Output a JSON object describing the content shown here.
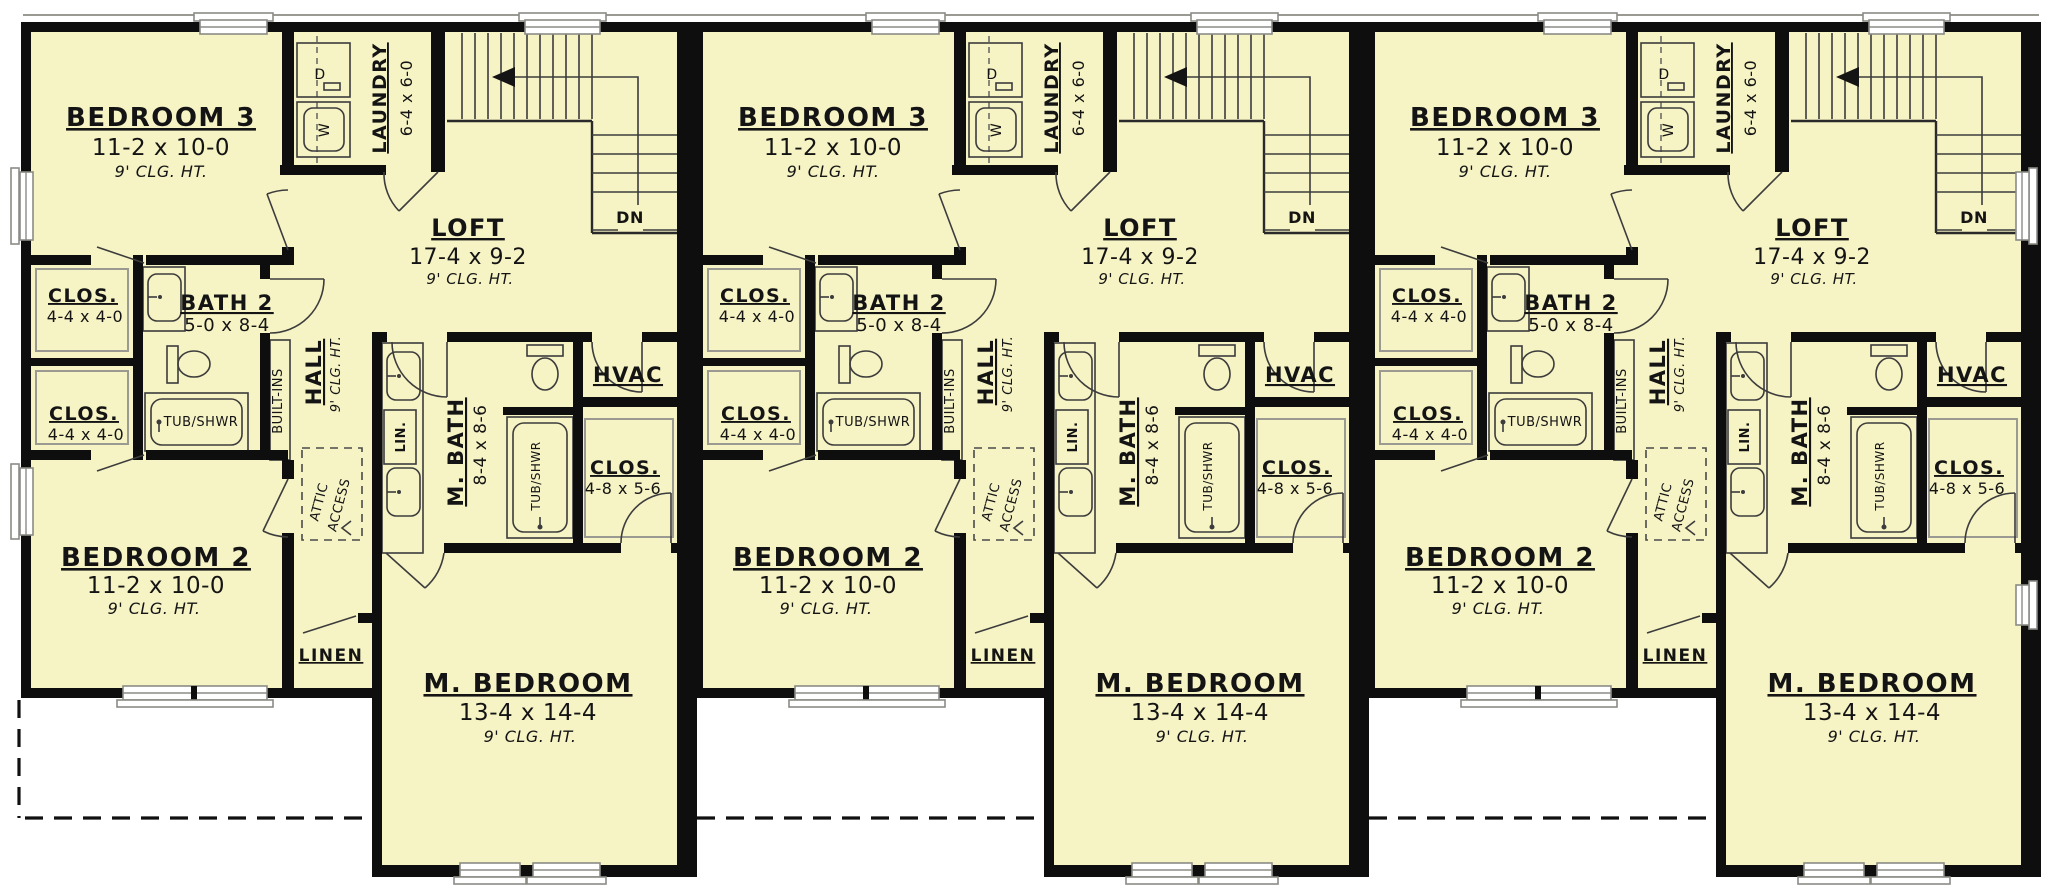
{
  "plan": {
    "unit_count": 3,
    "colors": {
      "floor_fill": "#f6f3c5",
      "wall": "#0e0e0e",
      "background": "#ffffff",
      "dashed_line": "#101010"
    },
    "rooms": {
      "bedroom3": {
        "name": "BEDROOM 3",
        "dims": "11-2 x 10-0",
        "ceiling": "9' CLG. HT."
      },
      "laundry": {
        "name": "LAUNDRY",
        "dims": "6-4 x 6-0"
      },
      "loft": {
        "name": "LOFT",
        "dims": "17-4 x 9-2",
        "ceiling": "9' CLG. HT."
      },
      "closet": {
        "name": "CLOS.",
        "dims": "4-4 x 4-0"
      },
      "bath2": {
        "name": "BATH 2",
        "dims": "5-0 x 8-4"
      },
      "hall": {
        "name": "HALL",
        "ceiling": "9' CLG. HT."
      },
      "master_bath": {
        "name": "M. BATH",
        "dims": "8-4 x 8-6"
      },
      "hvac": {
        "name": "HVAC"
      },
      "master_closet": {
        "name": "CLOS.",
        "dims": "4-8 x 5-6"
      },
      "bedroom2": {
        "name": "BEDROOM 2",
        "dims": "11-2 x 10-0",
        "ceiling": "9' CLG. HT."
      },
      "linen": {
        "name": "LINEN"
      },
      "master_bedroom": {
        "name": "M. BEDROOM",
        "dims": "13-4 x 14-4",
        "ceiling": "9' CLG. HT."
      }
    },
    "labels": {
      "tub_shower": "TUB/SHWR",
      "built_ins": "BUILT-INS",
      "attic_access_line1": "ATTIC",
      "attic_access_line2": "ACCESS",
      "linen_cabinet": "LIN.",
      "stairs_down": "DN",
      "dryer": "D",
      "washer": "W"
    }
  }
}
